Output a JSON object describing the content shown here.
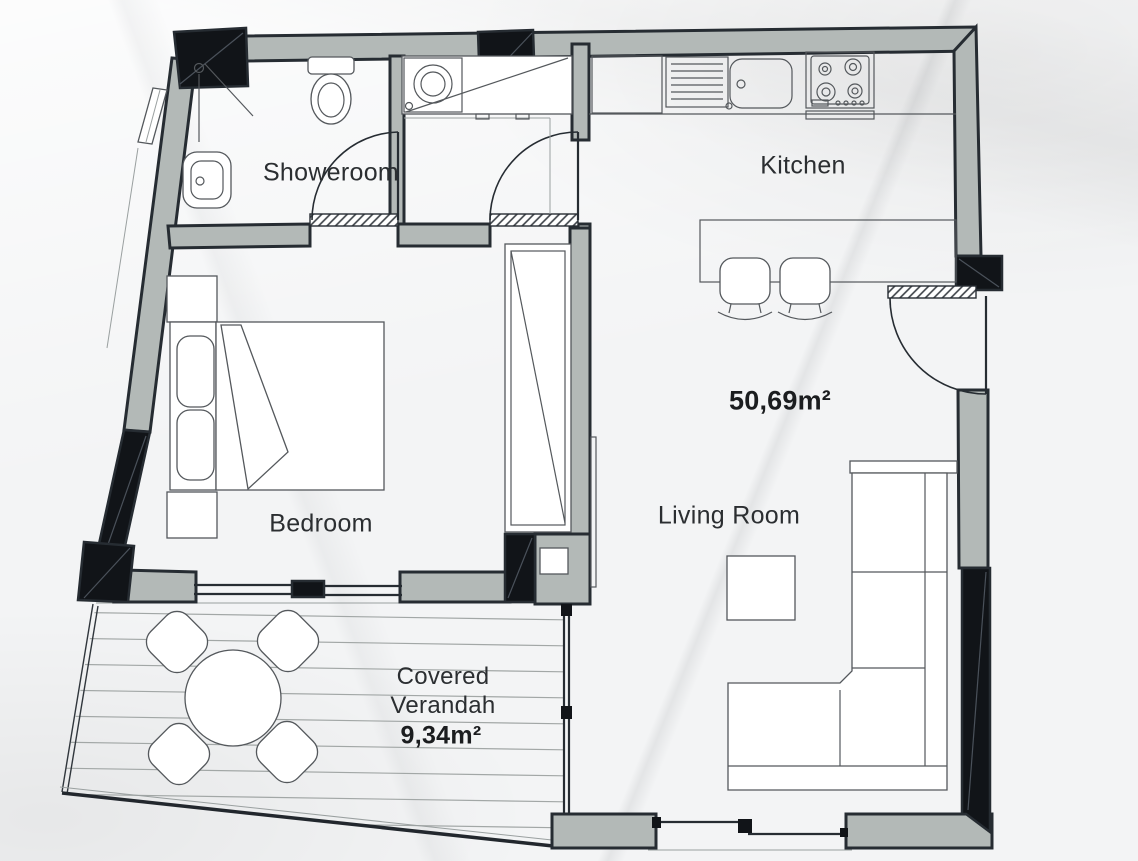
{
  "colors": {
    "wall_fill": "#b3b9b7",
    "outline": "#262c32",
    "black": "#111418",
    "paper": "#f3f4f5",
    "line": "#54585c",
    "text": "#2b2e31",
    "deck_line": "#a2a7a6"
  },
  "labels": {
    "showeroom": "Showeroom",
    "kitchen": "Kitchen",
    "total_area": "50,69m²",
    "bedroom": "Bedroom",
    "living_room": "Living Room",
    "verandah_line1": "Covered",
    "verandah_line2": "Verandah",
    "verandah_area": "9,34m²"
  },
  "fixtures": {
    "showeroom": [
      "corner-shower",
      "toilet",
      "washbasin"
    ],
    "hall": [
      "washing-machine-closet"
    ],
    "kitchen": [
      "base-cabinet",
      "drainer",
      "kitchen-sink",
      "hob-4-burner",
      "breakfast-bar",
      "bar-stool",
      "bar-stool"
    ],
    "bedroom": [
      "double-bed",
      "pillow",
      "pillow",
      "nightstand",
      "nightstand",
      "wardrobe"
    ],
    "living_room": [
      "corner-sofa",
      "coffee-table"
    ],
    "verandah": [
      "round-table",
      "outdoor-chair",
      "outdoor-chair",
      "outdoor-chair",
      "outdoor-chair",
      "timber-deck"
    ],
    "openings": [
      "entrance-door",
      "showeroom-door",
      "hall-door",
      "sliding-window",
      "sliding-glass-door"
    ]
  }
}
